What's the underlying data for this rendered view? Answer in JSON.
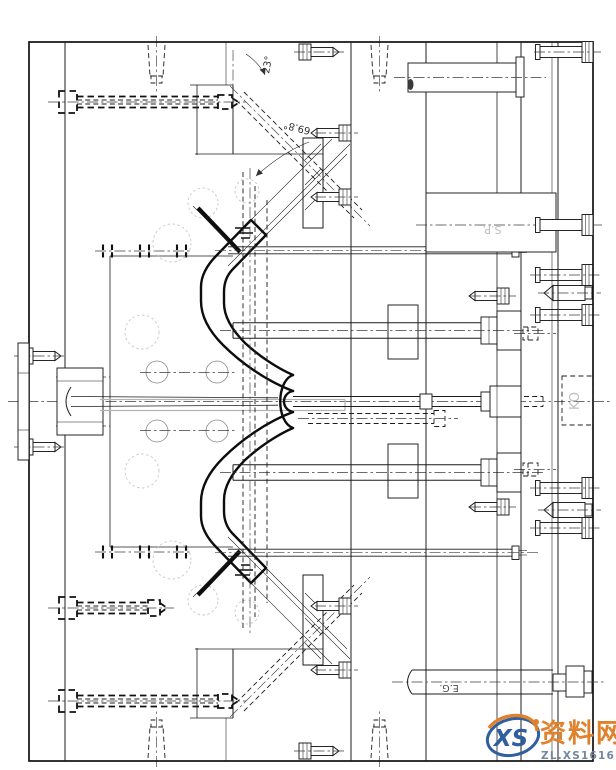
{
  "drawing": {
    "type": "injection-mold-assembly-section",
    "labels": {
      "guide_pin_angle": "23°",
      "lifter_angle": "69.8°",
      "support_pillar": "S.P.",
      "knockout": "KO",
      "ejector_guide": "E.G."
    },
    "line_color": "#1c1c1c"
  },
  "watermark": {
    "logo": "XS",
    "site_name": "资料网",
    "site_url": "ZL.XS1616.COM",
    "orange": "#e0812c",
    "blue": "#2f5f9e",
    "url_color": "#73879e"
  }
}
